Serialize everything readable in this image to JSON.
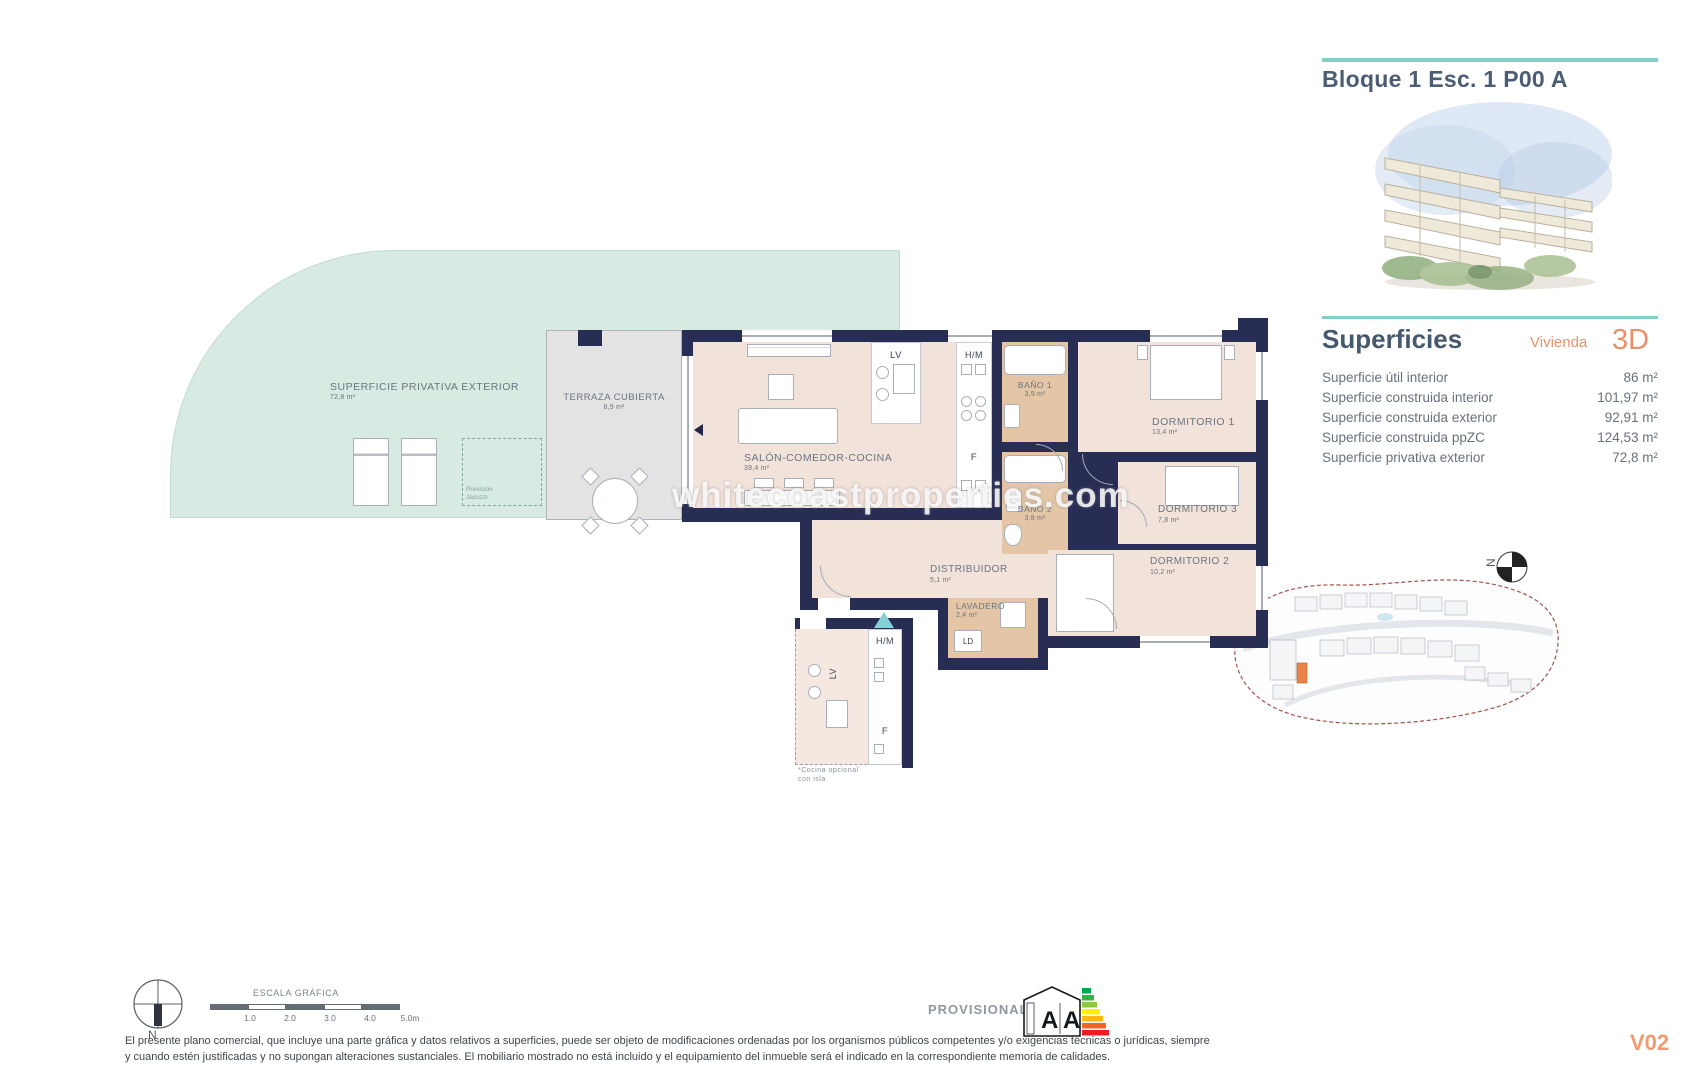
{
  "header": {
    "title": "Bloque 1 Esc. 1 P00 A"
  },
  "superficies": {
    "heading": "Superficies",
    "vivienda_label": "Vivienda",
    "vivienda_value": "3D",
    "rows": [
      {
        "label": "Superficie útil interior",
        "value": "86 m²"
      },
      {
        "label": "Superficie construida interior",
        "value": "101,97 m²"
      },
      {
        "label": "Superficie construida exterior",
        "value": "92,91 m²"
      },
      {
        "label": "Superficie construida ppZC",
        "value": "124,53 m²"
      },
      {
        "label": "Superficie privativa exterior",
        "value": "72,8 m²"
      }
    ]
  },
  "site_plan": {
    "floor_label": "P00",
    "north_label": "N"
  },
  "floor_plan": {
    "watermark": "whitecoastproperties.com",
    "rooms": {
      "exterior": {
        "name": "SUPERFICIE PRIVATIVA EXTERIOR",
        "area": "72,8 m²"
      },
      "terraza": {
        "name": "TERRAZA CUBIERTA",
        "area": "8,9 m²"
      },
      "salon": {
        "name": "SALÓN-COMEDOR-COCINA",
        "area": "39,4 m²"
      },
      "bano1": {
        "name": "BAÑO 1",
        "area": "3,9 m²"
      },
      "bano2": {
        "name": "BAÑO 2",
        "area": "3,8 m²"
      },
      "dorm1": {
        "name": "DORMITORIO 1",
        "area": "13,4 m²"
      },
      "dorm2": {
        "name": "DORMITORIO 2",
        "area": "10,2 m²"
      },
      "dorm3": {
        "name": "DORMITORIO 3",
        "area": "7,8 m²"
      },
      "distribuidor": {
        "name": "DISTRIBUIDOR",
        "area": "5,1 m²"
      },
      "lavadero": {
        "name": "LAVADERO",
        "area": "2,4 m²"
      }
    },
    "appliances": {
      "lv": "LV",
      "hm": "H/M",
      "f": "F",
      "ld": "LD"
    },
    "annotations": {
      "prevision_line1": "Previsión",
      "prevision_line2": "Jacuzzi",
      "kitchen_note_line1": "*Cocina opcional",
      "kitchen_note_line2": "con isla"
    }
  },
  "footer": {
    "scale": {
      "label": "ESCALA GRÁFICA",
      "ticks": [
        "1.0",
        "2.0",
        "3.0",
        "4.0",
        "5.0m"
      ]
    },
    "north_label": "N",
    "provisional": "PROVISIONAL",
    "energy": {
      "letters": [
        "A",
        "A"
      ],
      "colors": [
        "#00A650",
        "#33B44A",
        "#8DC63F",
        "#FFF200",
        "#FDB913",
        "#F26522",
        "#ED1C24"
      ]
    },
    "disclaimer": "El presente plano comercial, que incluye una parte gráfica y datos relativos a superficies, puede ser objeto de modificaciones ordenadas por los organismos públicos competentes y/o exigencias técnicas o jurídicas, siempre y cuando estén justificadas y no supongan alteraciones sustanciales. El mobiliario mostrado no está incluido y el equipamiento del inmueble será el indicado en la correspondiente memoria de calidades.",
    "version": "V02"
  },
  "colors": {
    "accent_teal": "#82CFC6",
    "accent_orange": "#E9906B",
    "wall_navy": "#282D54",
    "mint_exterior": "#D8EBE2",
    "terrace_gray": "#E3E3E3",
    "interior_beige": "#F2E3DA",
    "wet_room_tan": "#E4C6A7",
    "site_highlight": "#E8834A",
    "entrance_marker": "#85D1D8"
  }
}
